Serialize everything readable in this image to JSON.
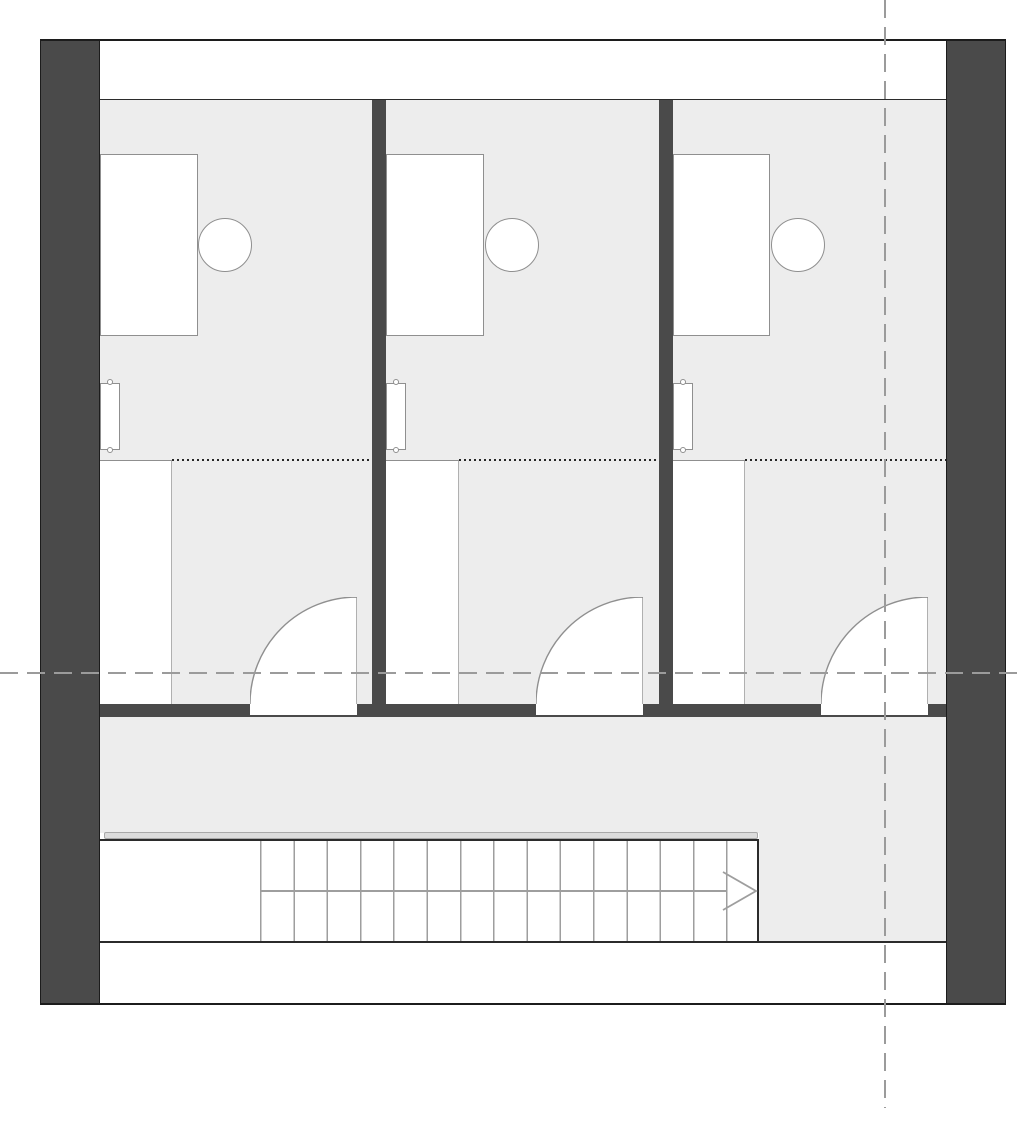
{
  "plan": {
    "type": "floor-plan",
    "description": "attic level plan: three identical rooms with desks, chairs, radiators and closets; corridor; straight staircase with direction arrow; dashed reference centerlines",
    "rooms": [
      {
        "id": "room-1",
        "furniture": [
          "desk",
          "chair",
          "radiator",
          "closet"
        ],
        "has_door": true,
        "dotted_ceiling_line": true
      },
      {
        "id": "room-2",
        "furniture": [
          "desk",
          "chair",
          "radiator",
          "closet"
        ],
        "has_door": true,
        "dotted_ceiling_line": true
      },
      {
        "id": "room-3",
        "furniture": [
          "desk",
          "chair",
          "radiator",
          "closet"
        ],
        "has_door": true,
        "dotted_ceiling_line": true
      }
    ],
    "corridor": {
      "present": true
    },
    "staircase": {
      "tread_lines": 15,
      "steps": 14,
      "direction_arrow": "right"
    },
    "reference_lines": {
      "horizontal_centerlines": 1,
      "vertical_centerlines": 1
    },
    "doors": 3,
    "exterior_wall_columns": 2,
    "partition_walls": 2
  },
  "colors": {
    "wall-dark": "#4a4a4a",
    "wall-outline": "#1c1c1c",
    "floor-fill": "#ededed",
    "line-dark": "#2b2b2b",
    "furniture-stroke": "#8f8f8f",
    "tread-stroke": "#9e9e9e",
    "dash-gray": "#9b9b9b",
    "dot-dark": "#262626",
    "band-fill": "#dcdcdc",
    "paper-white": "#ffffff"
  }
}
